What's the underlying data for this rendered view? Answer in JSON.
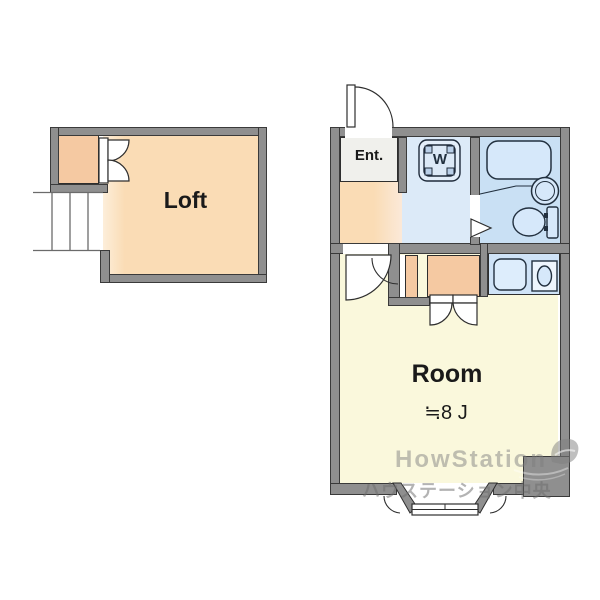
{
  "loft_plan": {
    "room_label": "Loft"
  },
  "main_plan": {
    "entrance_label": "Ent.",
    "washer_label": "W",
    "room_label": "Room",
    "room_size_label": "≒8 J"
  },
  "watermark": {
    "brand": "HowStation",
    "subtitle": "ハウステーション中央"
  },
  "colors": {
    "wall_gray": "#8f8f8f",
    "outline": "#2e2e2e",
    "loft_floor_peach": "#fadcb5",
    "closet_peach": "#f5c9a2",
    "entrance_gray": "#f0f0ec",
    "wet_area_blue": "#dceaf8",
    "bathroom_blue": "#c9e0f4",
    "kitchen_counter_blue": "#cfe3f7",
    "room_floor_yellow": "#faf8dc",
    "fixture_fill_blue": "#d6e8fa",
    "watermark_gray": "#8a8a8a"
  }
}
